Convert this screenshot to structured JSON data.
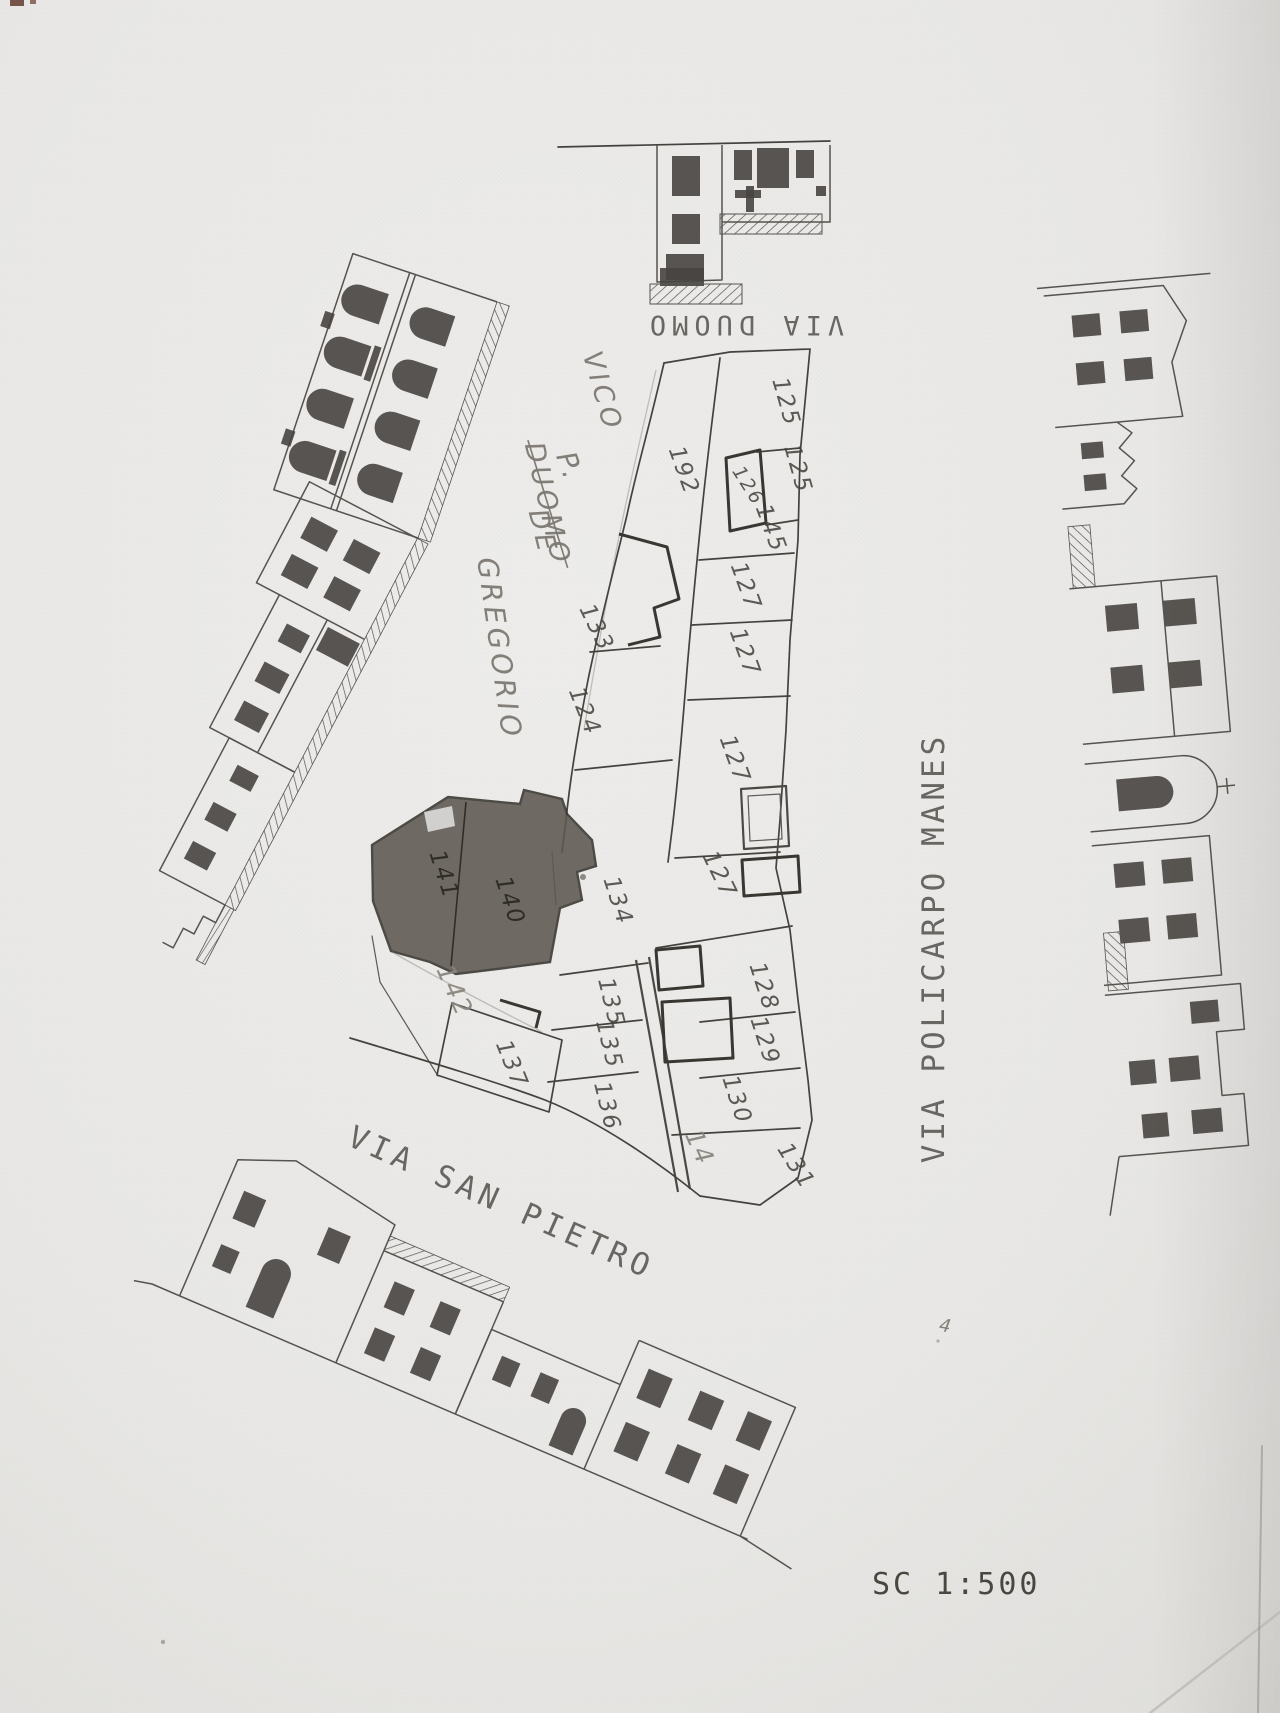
{
  "scale": {
    "label": "SC 1:500"
  },
  "colors": {
    "paper": "#e8e7e5",
    "ink": "#45423e",
    "pencil": "#8a867f",
    "dark_building_fill": "#5d5851"
  },
  "streets": [
    {
      "id": "via-duomo",
      "name": "VIA DUOMO",
      "x": 744,
      "y": 316,
      "rotation": 180,
      "size": 27,
      "spacing": 6
    },
    {
      "id": "via-policarpo-manes",
      "name": "VIA POLICARPO MANES",
      "x": 944,
      "y": 948,
      "rotation": -90,
      "size": 31,
      "spacing": 4
    },
    {
      "id": "via-san-pietro",
      "name": "VIA SAN PIETRO",
      "x": 497,
      "y": 1212,
      "rotation": 24,
      "size": 31,
      "spacing": 5
    }
  ],
  "handwritten_annotations": [
    {
      "text": "VICO",
      "x": 594,
      "y": 394,
      "rotation": 74,
      "size": 27,
      "strike": false
    },
    {
      "text": "DUOMO",
      "x": 539,
      "y": 506,
      "rotation": 77,
      "size": 27,
      "strike": true
    },
    {
      "text": "P.",
      "x": 561,
      "y": 470,
      "rotation": 70,
      "size": 28,
      "strike": false
    },
    {
      "text": "DE",
      "x": 534,
      "y": 534,
      "rotation": 76,
      "size": 27,
      "strike": false
    },
    {
      "text": "GREGORIO",
      "x": 490,
      "y": 650,
      "rotation": 82,
      "size": 28,
      "strike": false
    },
    {
      "text": "4",
      "x": 946,
      "y": 1332,
      "rotation": 10,
      "size": 18,
      "strike": false
    }
  ],
  "parcels": [
    {
      "number": "125",
      "x": 779,
      "y": 404,
      "rotation": 74,
      "style": "pen"
    },
    {
      "number": "125",
      "x": 791,
      "y": 471,
      "rotation": 74,
      "style": "pen"
    },
    {
      "number": "126",
      "x": 743,
      "y": 489,
      "rotation": 58,
      "style": "small"
    },
    {
      "number": "145",
      "x": 764,
      "y": 531,
      "rotation": 70,
      "style": "pen"
    },
    {
      "number": "192",
      "x": 677,
      "y": 473,
      "rotation": 70,
      "style": "pen"
    },
    {
      "number": "133",
      "x": 590,
      "y": 631,
      "rotation": 64,
      "style": "pen"
    },
    {
      "number": "124",
      "x": 578,
      "y": 714,
      "rotation": 68,
      "style": "pen"
    },
    {
      "number": "127",
      "x": 739,
      "y": 589,
      "rotation": 70,
      "style": "pen"
    },
    {
      "number": "127",
      "x": 738,
      "y": 655,
      "rotation": 70,
      "style": "pen"
    },
    {
      "number": "127",
      "x": 728,
      "y": 762,
      "rotation": 70,
      "style": "pen"
    },
    {
      "number": "127",
      "x": 713,
      "y": 878,
      "rotation": 64,
      "style": "pen"
    },
    {
      "number": "134",
      "x": 611,
      "y": 903,
      "rotation": 72,
      "style": "pen"
    },
    {
      "number": "128",
      "x": 757,
      "y": 989,
      "rotation": 72,
      "style": "pen"
    },
    {
      "number": "129",
      "x": 758,
      "y": 1043,
      "rotation": 72,
      "style": "pen"
    },
    {
      "number": "130",
      "x": 730,
      "y": 1102,
      "rotation": 72,
      "style": "pen"
    },
    {
      "number": "131",
      "x": 790,
      "y": 1170,
      "rotation": 58,
      "style": "pen"
    },
    {
      "number": "135",
      "x": 604,
      "y": 1004,
      "rotation": 76,
      "style": "pen"
    },
    {
      "number": "135",
      "x": 602,
      "y": 1046,
      "rotation": 76,
      "style": "pen"
    },
    {
      "number": "136",
      "x": 600,
      "y": 1108,
      "rotation": 76,
      "style": "pen"
    },
    {
      "number": "137",
      "x": 505,
      "y": 1067,
      "rotation": 68,
      "style": "pen"
    },
    {
      "number": "141",
      "x": 437,
      "y": 877,
      "rotation": 72,
      "style": "ondark"
    },
    {
      "number": "140",
      "x": 503,
      "y": 903,
      "rotation": 72,
      "style": "ondark"
    },
    {
      "number": "142",
      "x": 447,
      "y": 994,
      "rotation": 66,
      "style": "pencil"
    },
    {
      "number": "14",
      "x": 692,
      "y": 1151,
      "rotation": 66,
      "style": "pencil"
    }
  ]
}
